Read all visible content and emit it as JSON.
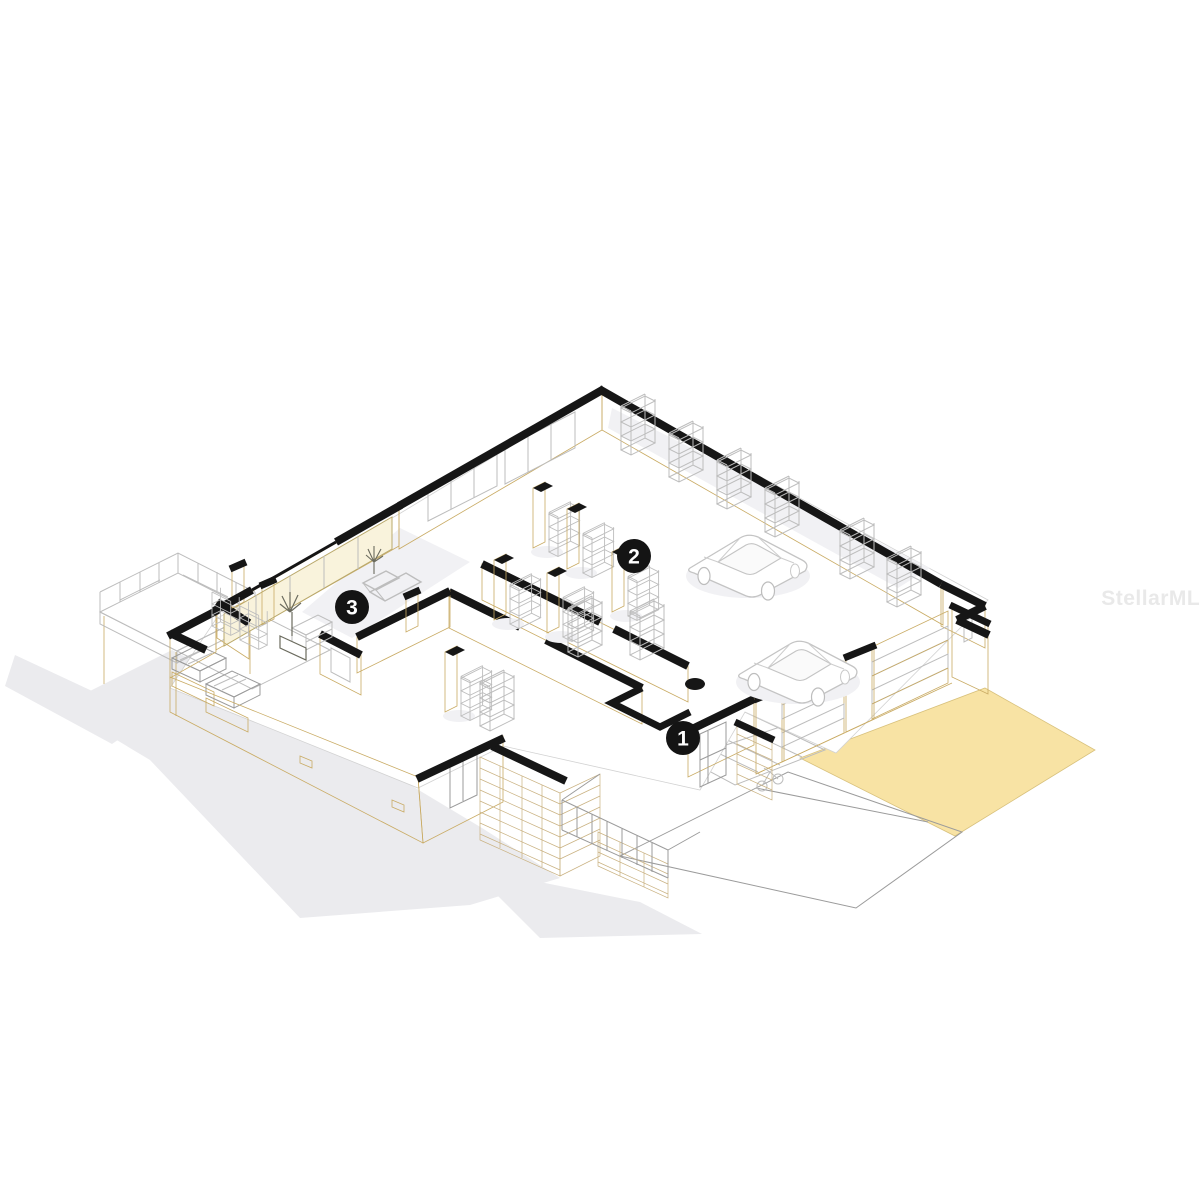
{
  "image": {
    "kind": "isometric cutaway floor-plan rendering of a single-story house with attached garage",
    "background": "#ffffff"
  },
  "watermark": {
    "text": "StellarMLS"
  },
  "markers": [
    {
      "label": "1"
    },
    {
      "label": "2"
    },
    {
      "label": "3"
    }
  ],
  "colors": {
    "wall": "#f2e2a8",
    "wall_dark": "#ecd795",
    "wall_edge": "#c9ab64",
    "glass": "#f9f3dc",
    "floor": "#ffffff",
    "driveway": "#f8e3a4",
    "stone": "#eedfb0",
    "stone_dark": "#e7d29c",
    "stone_line": "#c9b180",
    "cut": "#161616",
    "outline": "#bdbdbd",
    "shadow": "#ebebee",
    "shadow_light": "#f1f1f4",
    "watermark": "#e9e9e9",
    "marker_bg": "#141414",
    "marker_text": "#ffffff"
  }
}
